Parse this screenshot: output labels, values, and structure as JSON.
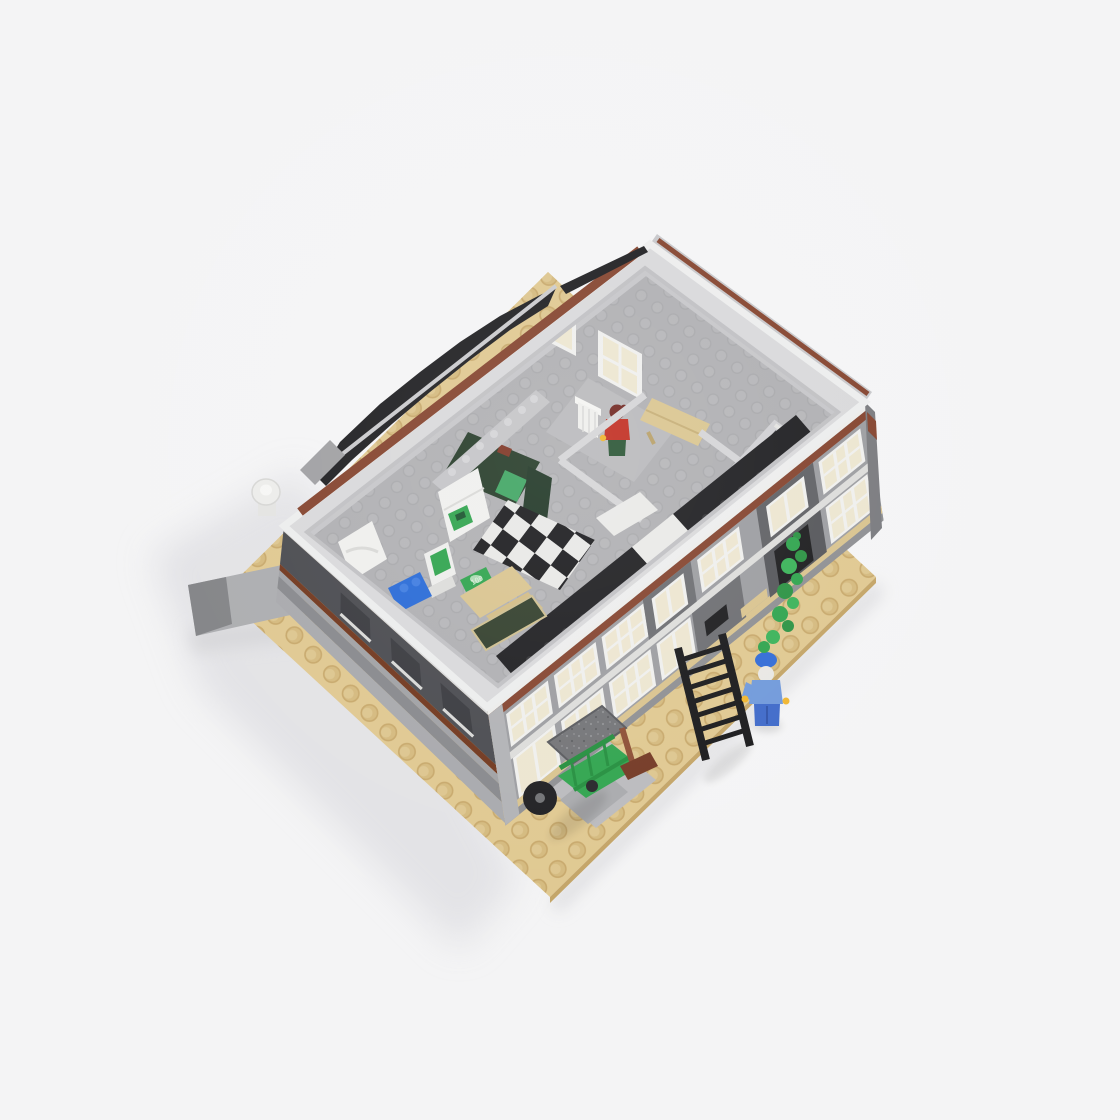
{
  "scene": {
    "subject": "LEGO modular building photographed from above with the roof removed, exposing interior rooms",
    "setting": "plain light-gray studio backdrop with soft shadow falling to the lower left",
    "baseplate": {
      "label": "tan stud baseplate",
      "color": "#dfc78e"
    },
    "building": {
      "label": "two-story gray modular building",
      "wall_color": "#9a9b9f",
      "trim_stripe_color": "#82402a",
      "roof_color": "#1a1a1d",
      "window_frame_color": "#efefed",
      "window_pane_color": "#ece5cf"
    },
    "interior": {
      "rooms": [
        {
          "label": "vault-room",
          "wall_color": "#223825",
          "door": "transparent green vault door"
        },
        {
          "label": "office",
          "items": [
            "computer with green screen",
            "green atm unit",
            "blue seat brick",
            "cash bill",
            "tan desk",
            "dark-green chalkboard"
          ]
        },
        {
          "label": "upper-room",
          "items": [
            "tan bench table",
            "white column"
          ]
        },
        {
          "label": "corner-shaft",
          "items": [
            "open stairwell shaft"
          ]
        }
      ],
      "floor_details": [
        "black-and-white checkered floor",
        "white staircase",
        "black tiled parapet strips",
        "gray studded ledge"
      ]
    },
    "minifigures": [
      {
        "label": "office-worker",
        "hair": "dark red bun",
        "torso": "red",
        "legs": "dark green",
        "location": "upper room beside bench"
      },
      {
        "label": "window-washer",
        "cap": "blue",
        "beard": "white",
        "torso": "medium blue",
        "legs": "blue",
        "location": "on sidewalk beside ladder"
      }
    ],
    "props": [
      {
        "label": "black-ladder",
        "color": "#141416"
      },
      {
        "label": "green-hand-cart",
        "color": "#27a044",
        "wheel": "black"
      },
      {
        "label": "push-broom",
        "color": "#8a4a30"
      },
      {
        "label": "speckled-awning",
        "color": "#707174"
      },
      {
        "label": "ivy-vine",
        "color": "#2fa34a"
      },
      {
        "label": "white-corner-dish",
        "color": "#ececea"
      }
    ],
    "money_label": "100"
  },
  "palette": {
    "bg": "#f4f4f5",
    "shadow": "#dcdce0",
    "tan": "#dfc78e",
    "tanStud": "#d2b679",
    "tanEdge": "#c2a263",
    "white": "#efefed",
    "cream": "#ece5cf",
    "grayLighter": "#c6c6c9",
    "grayLight": "#b4b4b7",
    "grayMid": "#97989c",
    "grayDark": "#5b5c60",
    "grayDarker": "#46474c",
    "black": "#1a1a1d",
    "brown": "#82402a",
    "brownDark": "#6e3319",
    "green": "#2ba24a",
    "greenDark": "#223825",
    "greenTrans": "#44c271",
    "blue": "#2467d6",
    "blueMedium": "#6d97da",
    "red": "#c02a1d",
    "redHair": "#6e231d",
    "yellow": "#f0b429",
    "legGreen": "#265231"
  }
}
